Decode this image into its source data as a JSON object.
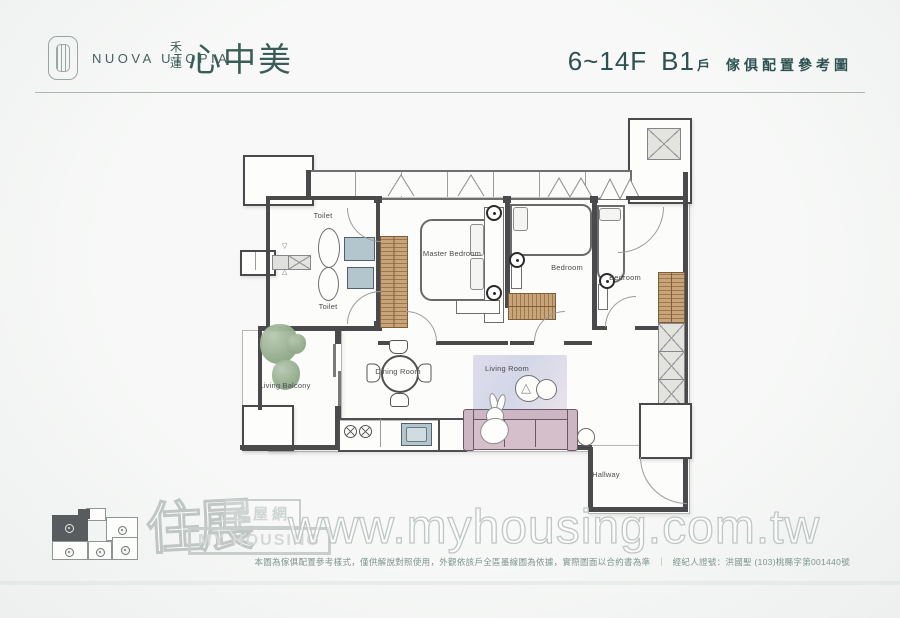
{
  "header": {
    "brand_en": "NUOVA UTOPIA",
    "brand_cn_vertical": "禾蓮",
    "brand_cn_main": "心中美",
    "title_floor": "6~14F",
    "title_unit": "B1",
    "title_unit_suffix": "戶",
    "title_desc": "傢俱配置參考圖"
  },
  "rooms": {
    "toilet_upper": "Toilet",
    "toilet_lower": "Toilet",
    "master_bedroom": "Master Bedroom",
    "bedroom_middle": "Bedroom",
    "bedroom_right": "Bedroom",
    "living_balcony": "Living Balcony",
    "dining_room": "Dining Room",
    "living_room": "Living Room",
    "hallway": "Hallway"
  },
  "icons": {
    "art_triangle": "△",
    "vent_top": "▽",
    "vent_bottom": "△"
  },
  "keyplan": {
    "unit_count": 5,
    "highlighted_unit": "B1"
  },
  "watermark": {
    "logo_script": "住展",
    "logo_site": "房屋網",
    "logo_en": "MY HOUSING",
    "url": "www.myhousing.com.tw"
  },
  "footer": {
    "disclaimer": "本圖為傢俱配置參考樣式，僅供解說對照使用，外觀依該戶全區墨線圖為依據，實際圖面以合約書為準",
    "separator": "｜",
    "license": "經紀人證號：洪國聖 (103)桃縣字第001440號"
  },
  "colors": {
    "accent_teal": "#2f5553",
    "wall": "#4a4a4c",
    "closet_wood": "#c9a478",
    "sofa": "#ccb6c3",
    "rug": "#d6d6e8",
    "plant": "#93ab8c",
    "watermark_gray": "#c2c9c6"
  }
}
